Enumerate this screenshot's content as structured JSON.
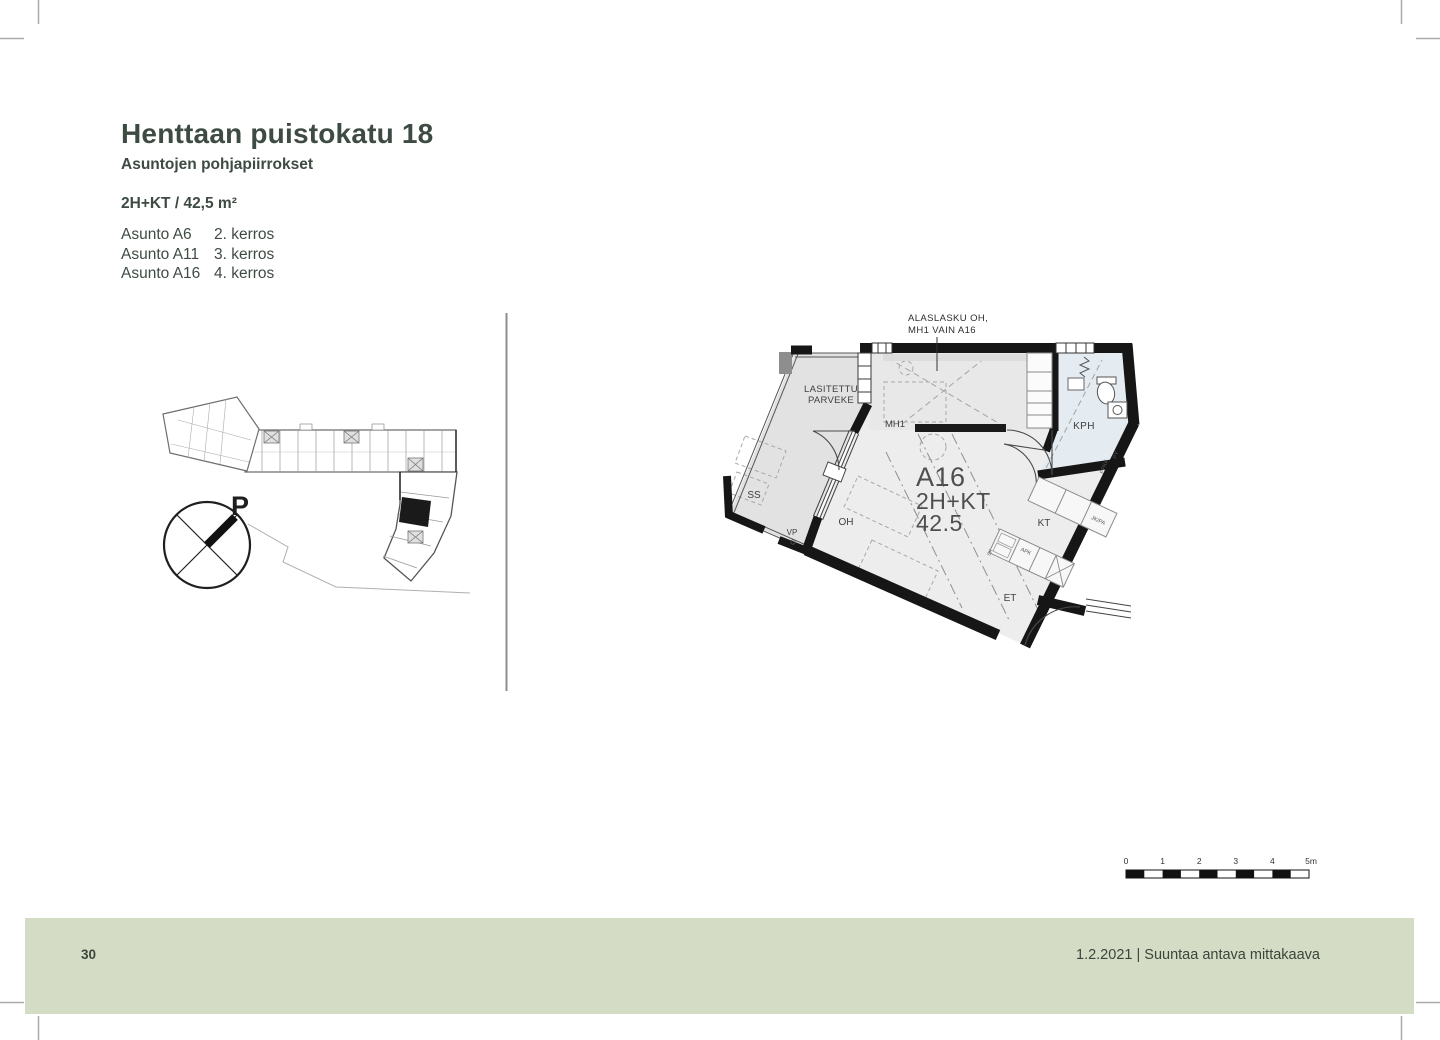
{
  "header": {
    "title": "Henttaan puistokatu 18",
    "subtitle": "Asuntojen pohjapiirrokset",
    "unit_spec": "2H+KT / 42,5 m²",
    "apartments": [
      {
        "name": "Asunto A6",
        "floor": "2. kerros"
      },
      {
        "name": "Asunto A11",
        "floor": "3. kerros"
      },
      {
        "name": "Asunto A16",
        "floor": "4. kerros"
      }
    ]
  },
  "site_plan": {
    "compass_label": "P"
  },
  "floor_plan": {
    "annotation": {
      "line1": "ALASLASKU OH,",
      "line2": "MH1 VAIN A16"
    },
    "unit": {
      "id": "A16",
      "type": "2H+KT",
      "area": "42.5"
    },
    "rooms": {
      "balcony_line1": "LASITETTU",
      "balcony_line2": "PARVEKE",
      "ss": "SS",
      "vp": "VP",
      "mh1": "MH1",
      "kph": "KPH",
      "oh": "OH",
      "kt": "KT",
      "et": "ET"
    },
    "fixtures": {
      "apk": "APK",
      "jk_pa": "JK/PA",
      "py": "PY",
      "ppkk": "PPKK",
      "sk": "SK"
    }
  },
  "scale_bar": {
    "labels": [
      "0",
      "1",
      "2",
      "3",
      "4",
      "5m"
    ]
  },
  "footer": {
    "page_number": "30",
    "caption": "1.2.2021 | Suuntaa antava mittakaava"
  },
  "colors": {
    "accent_text": "#3e4b42",
    "footer_band": "#d5dcc5",
    "bathroom_fill": "#e4ebf1",
    "wall": "#161616"
  }
}
